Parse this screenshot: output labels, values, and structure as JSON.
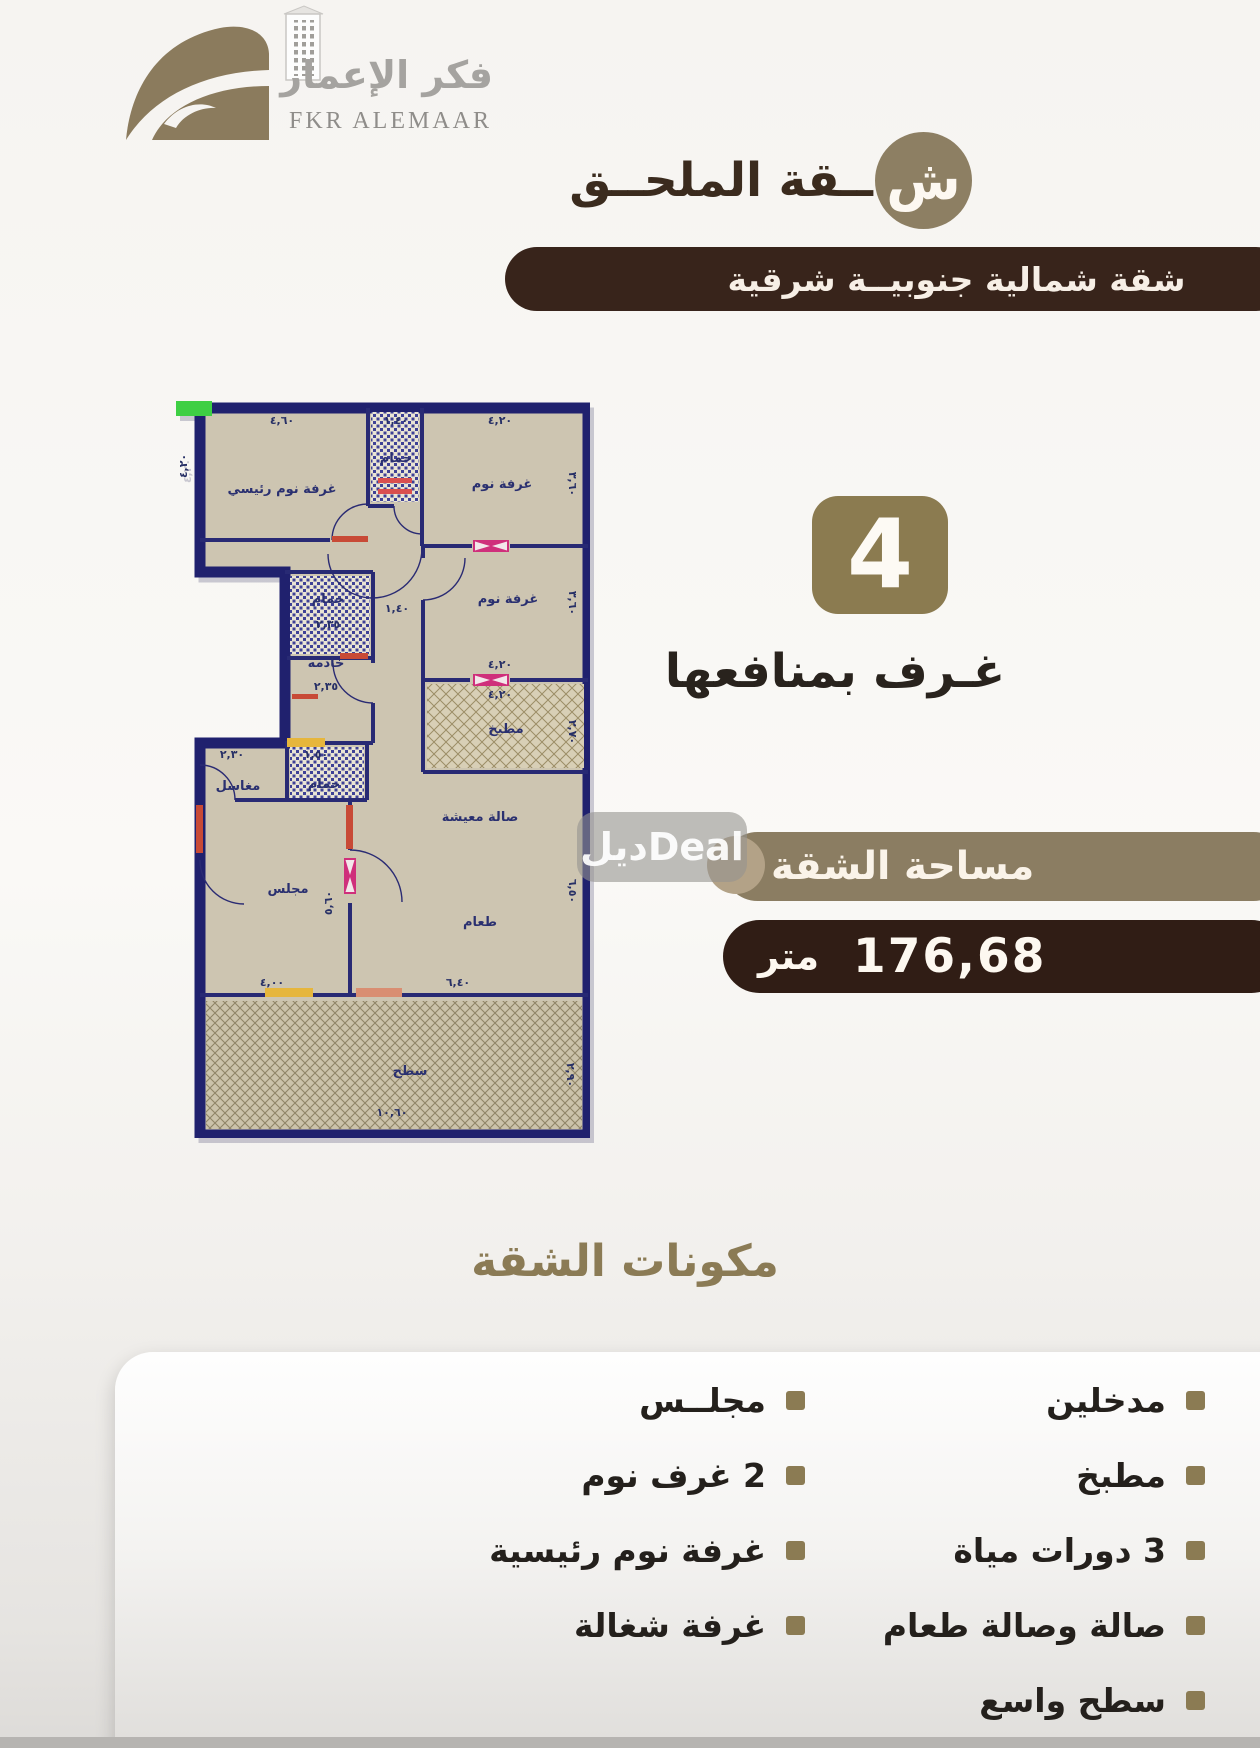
{
  "brand": {
    "name_ar": "فكر الإعمار",
    "name_en": "FKR ALEMAAR"
  },
  "header": {
    "title_initial": "ش",
    "title_rest": "ــقة الملحــق",
    "orientation_badge": "شقة شمالية جنوبيــة شرقية"
  },
  "highlight": {
    "rooms_count": "4",
    "rooms_label": "غـرف بمنافعها"
  },
  "area": {
    "label": "مساحة الشقة",
    "value": "176,68",
    "unit": "متر"
  },
  "watermark": {
    "text": "ديلDeal"
  },
  "components": {
    "heading": "مكونات الشقة",
    "right_column": [
      "مدخلين",
      "مطبخ",
      "3 دورات مياة",
      "صالة وصالة طعام",
      "سطح واسع"
    ],
    "left_column": [
      "مجلــس",
      "2 غرف نوم",
      "غرفة نوم رئيسية",
      "غرفة شغالة"
    ]
  },
  "colors": {
    "accent_olive": "#8b7c57",
    "accent_dark_brown": "#36231a",
    "plan_border_navy": "#20216e",
    "plan_fill_beige": "#cdc5b1"
  },
  "floorplan": {
    "labels": [
      {
        "t": "غرفة نوم رئيسي",
        "x": 112,
        "y": 135
      },
      {
        "t": "٤,٦٠",
        "x": 112,
        "y": 66,
        "dim": true
      },
      {
        "t": "١,٤٠",
        "x": 226,
        "y": 66,
        "dim": true
      },
      {
        "t": "حمام",
        "x": 226,
        "y": 104,
        "size": 12
      },
      {
        "t": "٤,٢٠",
        "x": 330,
        "y": 66,
        "dim": true
      },
      {
        "t": "غرفة نوم",
        "x": 332,
        "y": 130
      },
      {
        "t": "٣,٦٠",
        "x": 399,
        "y": 126,
        "dim": true,
        "rot": 90
      },
      {
        "t": "٤,٢٠",
        "x": 17,
        "y": 108,
        "dim": true,
        "rot": -90
      },
      {
        "t": "حمام",
        "x": 158,
        "y": 245,
        "size": 12
      },
      {
        "t": "٢,٣٥",
        "x": 158,
        "y": 270,
        "dim": true
      },
      {
        "t": "خادمه",
        "x": 156,
        "y": 309,
        "size": 12
      },
      {
        "t": "٢,٣٥",
        "x": 156,
        "y": 332,
        "dim": true
      },
      {
        "t": "١,٤٠",
        "x": 227,
        "y": 254,
        "dim": true
      },
      {
        "t": "غرفة نوم",
        "x": 338,
        "y": 245
      },
      {
        "t": "٣,٦٠",
        "x": 399,
        "y": 245,
        "dim": true,
        "rot": 90
      },
      {
        "t": "٤,٢٠",
        "x": 330,
        "y": 310,
        "dim": true
      },
      {
        "t": "٤,٢٠",
        "x": 330,
        "y": 340,
        "dim": true
      },
      {
        "t": "مطبخ",
        "x": 336,
        "y": 375
      },
      {
        "t": "٢,٧٠",
        "x": 399,
        "y": 374,
        "dim": true,
        "rot": 90
      },
      {
        "t": "٢,٣٠",
        "x": 62,
        "y": 400,
        "dim": true
      },
      {
        "t": "مغاسل",
        "x": 68,
        "y": 432,
        "size": 11
      },
      {
        "t": "١,٥٠",
        "x": 146,
        "y": 400,
        "dim": true
      },
      {
        "t": "حمام",
        "x": 154,
        "y": 430,
        "size": 12
      },
      {
        "t": "مجلس",
        "x": 118,
        "y": 535
      },
      {
        "t": "٥,٦٠",
        "x": 162,
        "y": 545,
        "dim": true,
        "rot": -90
      },
      {
        "t": "صالة معيشة",
        "x": 310,
        "y": 463
      },
      {
        "t": "طعام",
        "x": 310,
        "y": 568
      },
      {
        "t": "٦,٥٠",
        "x": 399,
        "y": 533,
        "dim": true,
        "rot": 90
      },
      {
        "t": "٤,٠٠",
        "x": 102,
        "y": 628,
        "dim": true
      },
      {
        "t": "٦,٤٠",
        "x": 288,
        "y": 628,
        "dim": true
      },
      {
        "t": "سطح",
        "x": 240,
        "y": 717
      },
      {
        "t": "١٠,٦٠",
        "x": 222,
        "y": 758,
        "dim": true
      },
      {
        "t": "٢,٩٠",
        "x": 397,
        "y": 717,
        "dim": true,
        "rot": 90
      }
    ]
  }
}
